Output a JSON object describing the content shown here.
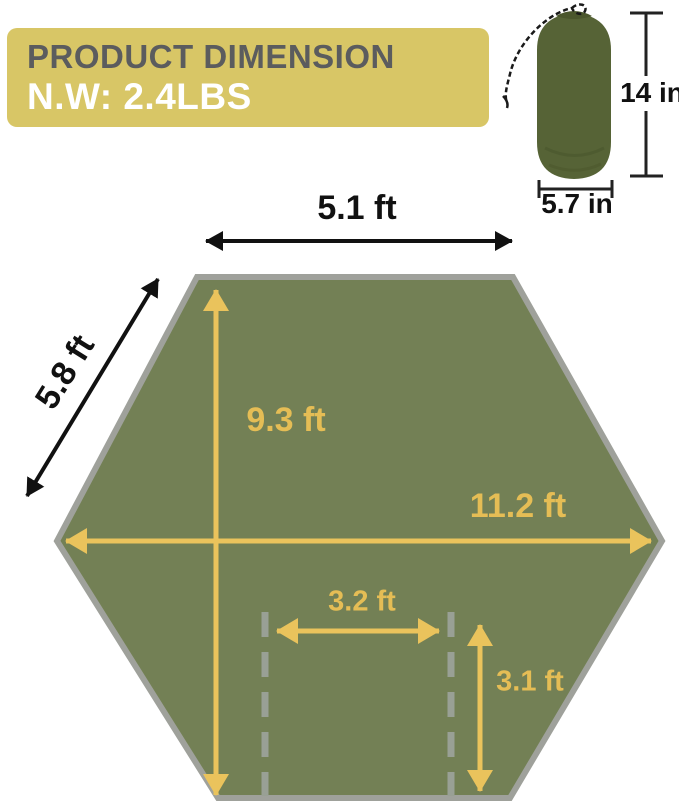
{
  "banner": {
    "title": "PRODUCT DIMENSION",
    "weight": "N.W: 2.4LBS",
    "bg_color": "#d8c666",
    "title_color": "#5b5c5e",
    "weight_color": "#ffffff"
  },
  "stuff_sack": {
    "height_label": "14 in",
    "width_label": "5.7 in",
    "bag_color": "#566336",
    "cord_color": "#1a1a1a"
  },
  "tarp": {
    "shape": "hexagon",
    "fill_color": "#738055",
    "border_color": "#9fa19b",
    "arrow_color": "#eac35c",
    "label_color": "#e5bd55",
    "dash_color": "#99a095",
    "dimensions": {
      "top_edge": "5.1 ft",
      "side_edge": "5.8 ft",
      "height": "9.3 ft",
      "width": "11.2 ft",
      "inner_width": "3.2 ft",
      "inner_height": "3.1 ft"
    }
  }
}
